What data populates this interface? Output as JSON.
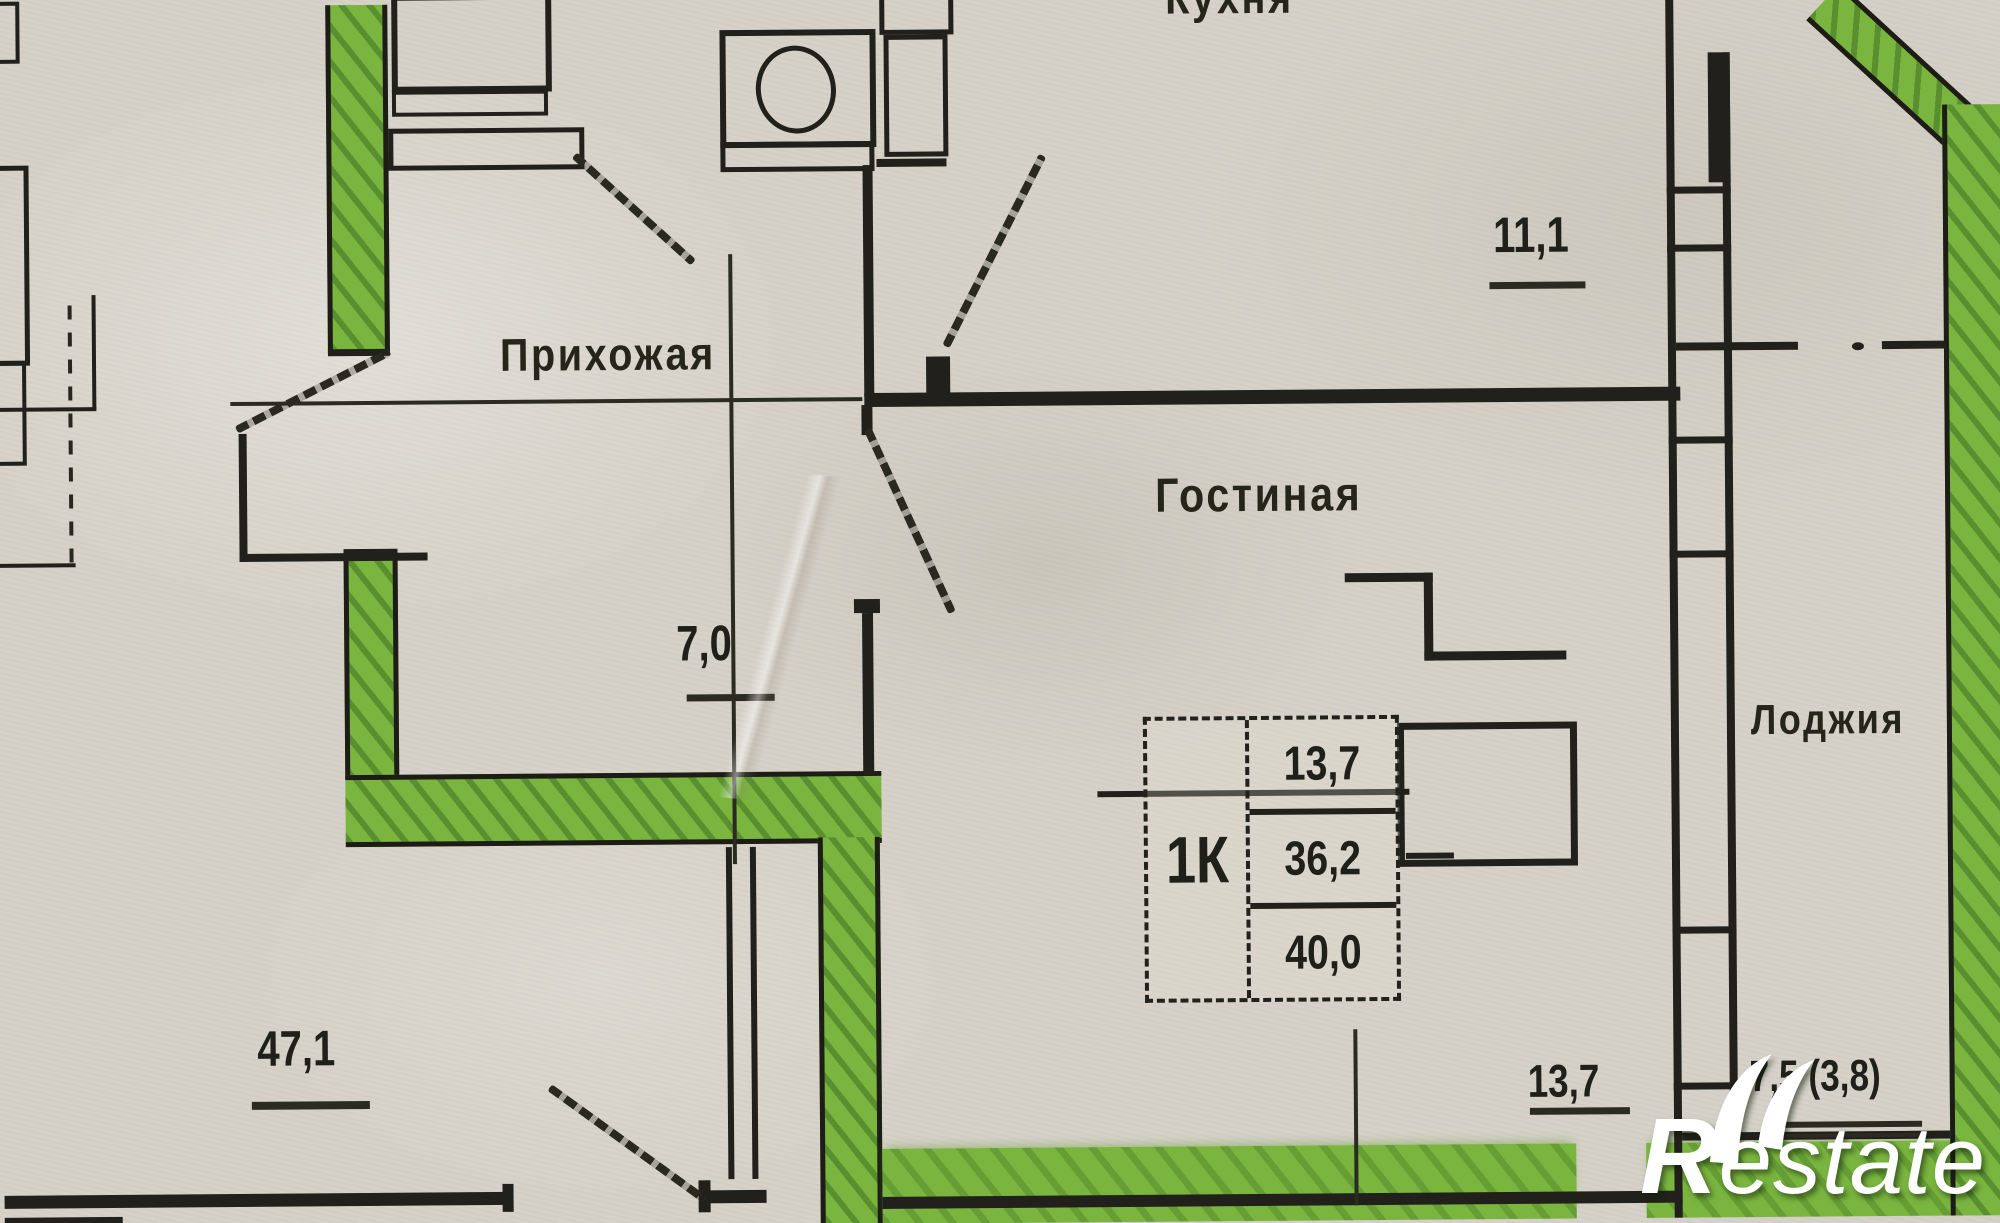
{
  "document": {
    "type": "apartment floor plan (scanned, Russian)",
    "highlight_note": "apartment boundary walls highlighted in green marker"
  },
  "rooms": {
    "kitchen": {
      "label": "Кухня",
      "area": "11,1"
    },
    "hallway": {
      "label": "Прихожая",
      "area": "7,0"
    },
    "living": {
      "label": "Гостиная",
      "area": "13,7"
    },
    "loggia": {
      "label": "Лоджия",
      "area": "7,5 (3,8)"
    },
    "neighbor": {
      "area": "47,1"
    }
  },
  "stamp": {
    "unit_type": "1К",
    "room_area": "13,7",
    "apartment_area": "36,2",
    "total_area": "40,0"
  },
  "watermark": {
    "brand": "Restate"
  },
  "colors": {
    "highlight_green": "#79b53f",
    "paper": "#d6d2c9",
    "ink": "#21201a",
    "watermark_white": "#ffffff"
  }
}
